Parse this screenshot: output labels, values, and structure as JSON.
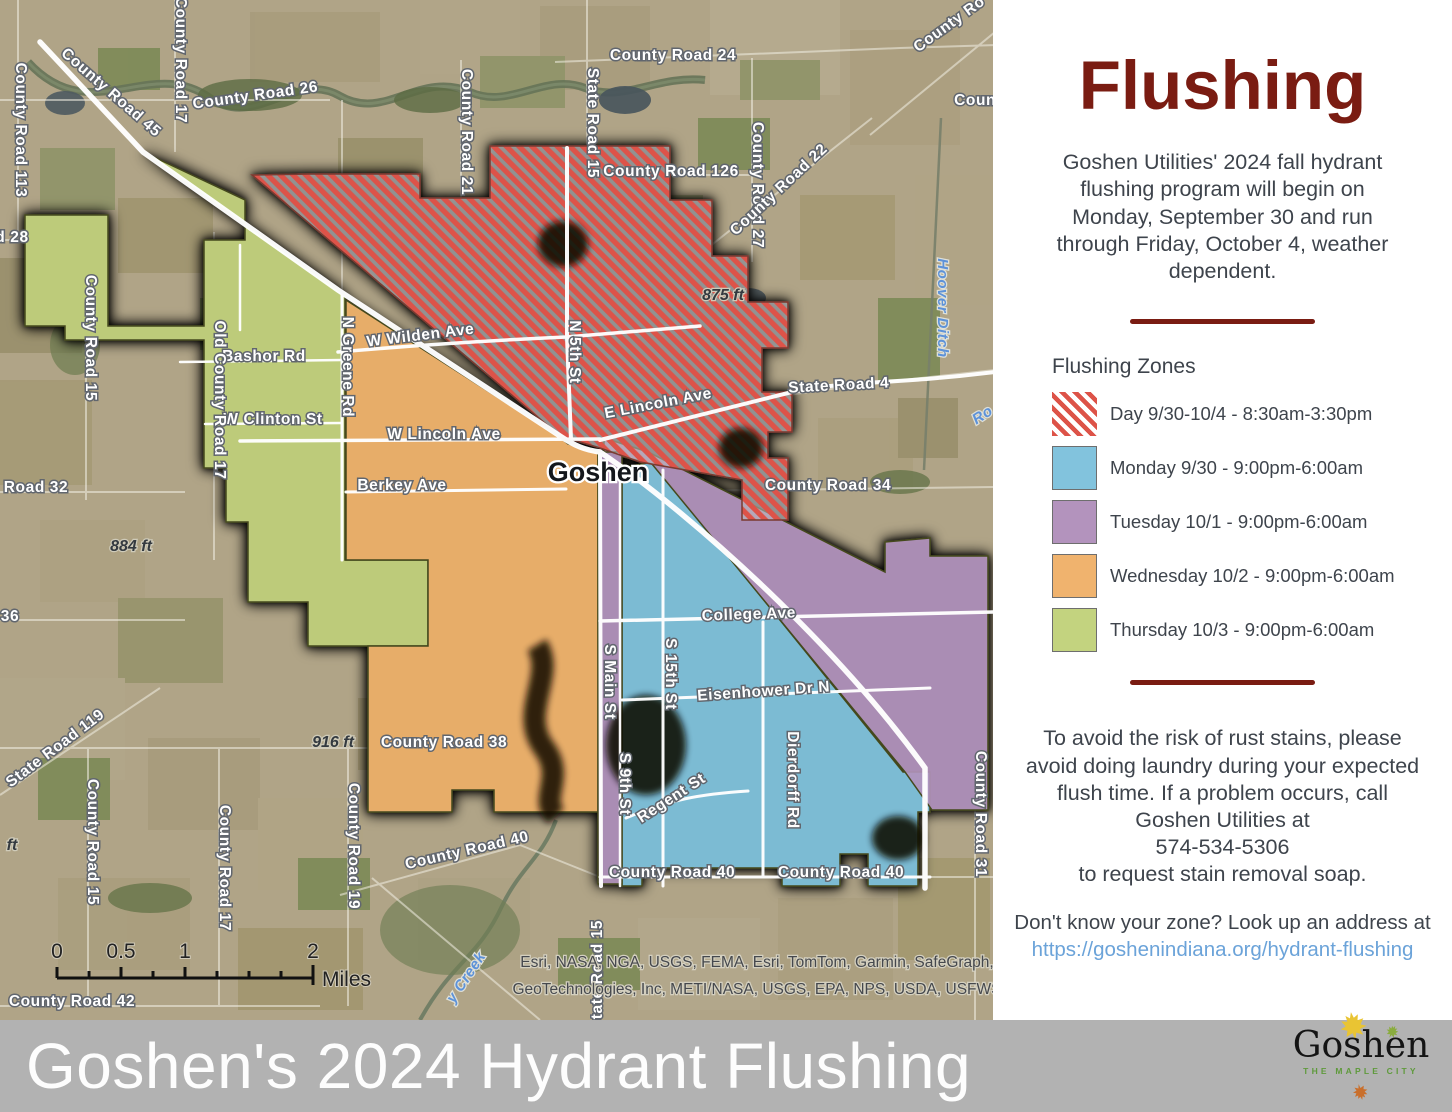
{
  "sidebar": {
    "title": "Flushing",
    "title_color": "#7a1c12",
    "intro": "Goshen Utilities' 2024 fall hydrant flushing program will begin on Monday, September 30 and run through Friday, October 4, weather dependent.",
    "legend": {
      "heading": "Flushing Zones",
      "items": [
        {
          "label": "Day 9/30-10/4 - 8:30am-3:30pm",
          "swatch": "hatch",
          "color": "#dd5348"
        },
        {
          "label": "Monday 9/30 - 9:00pm-6:00am",
          "swatch": "solid",
          "color": "#82c3dd"
        },
        {
          "label": "Tuesday 10/1 - 9:00pm-6:00am",
          "swatch": "solid",
          "color": "#b393bd"
        },
        {
          "label": "Wednesday 10/2 - 9:00pm-6:00am",
          "swatch": "solid",
          "color": "#f0b36e"
        },
        {
          "label": "Thursday 10/3 - 9:00pm-6:00am",
          "swatch": "solid",
          "color": "#c3d37f"
        }
      ]
    },
    "notice": "To avoid the risk of rust stains, please avoid doing laundry during your expected flush time. If a problem occurs, call Goshen Utilities at",
    "phone": "574-534-5306",
    "notice2": "to request stain removal soap.",
    "zone_lookup": "Don't know your zone? Look up an address at",
    "link": "https://goshenindiana.org/hydrant-flushing",
    "link_color": "#6ba3d9"
  },
  "banner": {
    "title": "Goshen's 2024 Hydrant Flushing",
    "bg": "#b2b2b2",
    "logo": {
      "name": "Goshen",
      "tagline": "THE MAPLE CITY"
    }
  },
  "map": {
    "scalebar": {
      "ticks": [
        "0",
        "0.5",
        "1",
        "2"
      ],
      "unit": "Miles"
    },
    "attribution": [
      "Esri, NASA, NGA, USGS, FEMA, Esri, TomTom, Garmin, SafeGraph,",
      "GeoTechnologies, Inc, METI/NASA, USGS, EPA, NPS, USDA, USFWS"
    ],
    "labels": [
      {
        "t": "County Road 45",
        "x": 108,
        "y": 96,
        "r": 41,
        "k": "road"
      },
      {
        "t": "County Road 113",
        "x": 16,
        "y": 130,
        "r": 90,
        "k": "road"
      },
      {
        "t": "d 28",
        "x": 12,
        "y": 242,
        "r": 0,
        "k": "road"
      },
      {
        "t": "County Road 26",
        "x": 256,
        "y": 100,
        "r": -8,
        "k": "road"
      },
      {
        "t": "County Road 17",
        "x": 176,
        "y": 60,
        "r": 90,
        "k": "road"
      },
      {
        "t": "County Road 21",
        "x": 462,
        "y": 132,
        "r": 90,
        "k": "road"
      },
      {
        "t": "County Road 24",
        "x": 673,
        "y": 60,
        "r": 0,
        "k": "road"
      },
      {
        "t": "State Road 15",
        "x": 588,
        "y": 123,
        "r": 90,
        "k": "road"
      },
      {
        "t": "County Road 27",
        "x": 753,
        "y": 185,
        "r": 90,
        "k": "road"
      },
      {
        "t": "County Road 126",
        "x": 671,
        "y": 176,
        "r": 0,
        "k": "road"
      },
      {
        "t": "County Road 22",
        "x": 782,
        "y": 193,
        "r": -43,
        "k": "road"
      },
      {
        "t": "County Ro",
        "x": 952,
        "y": 28,
        "r": -36,
        "k": "road"
      },
      {
        "t": "Count",
        "x": 978,
        "y": 105,
        "r": 0,
        "k": "road"
      },
      {
        "t": "State Road 4",
        "x": 839,
        "y": 390,
        "r": -3,
        "k": "road"
      },
      {
        "t": "County Road 34",
        "x": 828,
        "y": 490,
        "r": 0,
        "k": "road"
      },
      {
        "t": "N Greene Rd",
        "x": 343,
        "y": 367,
        "r": 90,
        "k": "road"
      },
      {
        "t": "W Wilden Ave",
        "x": 421,
        "y": 340,
        "r": -7,
        "k": "road"
      },
      {
        "t": "N 5th St",
        "x": 570,
        "y": 352,
        "r": 90,
        "k": "road"
      },
      {
        "t": "E Lincoln Ave",
        "x": 659,
        "y": 408,
        "r": -11,
        "k": "road"
      },
      {
        "t": "W Lincoln Ave",
        "x": 444,
        "y": 439,
        "r": 0,
        "k": "road"
      },
      {
        "t": "Berkey Ave",
        "x": 402,
        "y": 490,
        "r": 0,
        "k": "road"
      },
      {
        "t": "Bashor Rd",
        "x": 264,
        "y": 361,
        "r": 0,
        "k": "road"
      },
      {
        "t": "W Clinton St",
        "x": 273,
        "y": 424,
        "r": 0,
        "k": "road"
      },
      {
        "t": "Old County Road 17",
        "x": 215,
        "y": 400,
        "r": 90,
        "k": "road"
      },
      {
        "t": "County Road 15",
        "x": 86,
        "y": 338,
        "r": 90,
        "k": "road"
      },
      {
        "t": "Road 32",
        "x": 36,
        "y": 492,
        "r": 0,
        "k": "road"
      },
      {
        "t": "36",
        "x": 10,
        "y": 621,
        "r": 0,
        "k": "road"
      },
      {
        "t": "State Road 119",
        "x": 58,
        "y": 752,
        "r": -37,
        "k": "road"
      },
      {
        "t": "County Road 15",
        "x": 88,
        "y": 842,
        "r": 90,
        "k": "road"
      },
      {
        "t": "County Road 38",
        "x": 444,
        "y": 747,
        "r": 0,
        "k": "road"
      },
      {
        "t": "County Road 17",
        "x": 220,
        "y": 868,
        "r": 90,
        "k": "road"
      },
      {
        "t": "County Road 19",
        "x": 349,
        "y": 846,
        "r": 90,
        "k": "road"
      },
      {
        "t": "County Road 40",
        "x": 468,
        "y": 855,
        "r": -13,
        "k": "road"
      },
      {
        "t": "County Road 42",
        "x": 72,
        "y": 1006,
        "r": 0,
        "k": "road"
      },
      {
        "t": "County Road 40",
        "x": 672,
        "y": 877,
        "r": 0,
        "k": "road"
      },
      {
        "t": "County Road 40",
        "x": 841,
        "y": 877,
        "r": 0,
        "k": "road"
      },
      {
        "t": "Regent St",
        "x": 674,
        "y": 802,
        "r": -33,
        "k": "road"
      },
      {
        "t": "Eisenhower Dr N",
        "x": 764,
        "y": 696,
        "r": -4,
        "k": "road"
      },
      {
        "t": "Dierdorff Rd",
        "x": 788,
        "y": 780,
        "r": 90,
        "k": "road"
      },
      {
        "t": "College Ave",
        "x": 749,
        "y": 619,
        "r": -2,
        "k": "road"
      },
      {
        "t": "S 9th St",
        "x": 620,
        "y": 784,
        "r": 90,
        "k": "road"
      },
      {
        "t": "S 15th St",
        "x": 666,
        "y": 674,
        "r": 90,
        "k": "road"
      },
      {
        "t": "S Main St",
        "x": 605,
        "y": 682,
        "r": 90,
        "k": "road"
      },
      {
        "t": "County Road 31",
        "x": 976,
        "y": 814,
        "r": 90,
        "k": "road"
      },
      {
        "t": "State Road 15",
        "x": 602,
        "y": 975,
        "r": -90,
        "k": "road"
      },
      {
        "t": "Hoover Ditch",
        "x": 938,
        "y": 308,
        "r": 90,
        "k": "water"
      },
      {
        "t": "Ro",
        "x": 985,
        "y": 419,
        "r": -33,
        "k": "water"
      },
      {
        "t": "y Creek",
        "x": 470,
        "y": 980,
        "r": -56,
        "k": "water"
      },
      {
        "t": "875 ft",
        "x": 723,
        "y": 300,
        "r": 0,
        "k": "elev"
      },
      {
        "t": "884 ft",
        "x": 131,
        "y": 551,
        "r": 0,
        "k": "elev"
      },
      {
        "t": "916 ft",
        "x": 333,
        "y": 747,
        "r": 0,
        "k": "elev"
      },
      {
        "t": "ft",
        "x": 12,
        "y": 850,
        "r": 0,
        "k": "elev"
      },
      {
        "t": "Goshen",
        "x": 598,
        "y": 481,
        "r": 0,
        "k": "city"
      }
    ]
  }
}
